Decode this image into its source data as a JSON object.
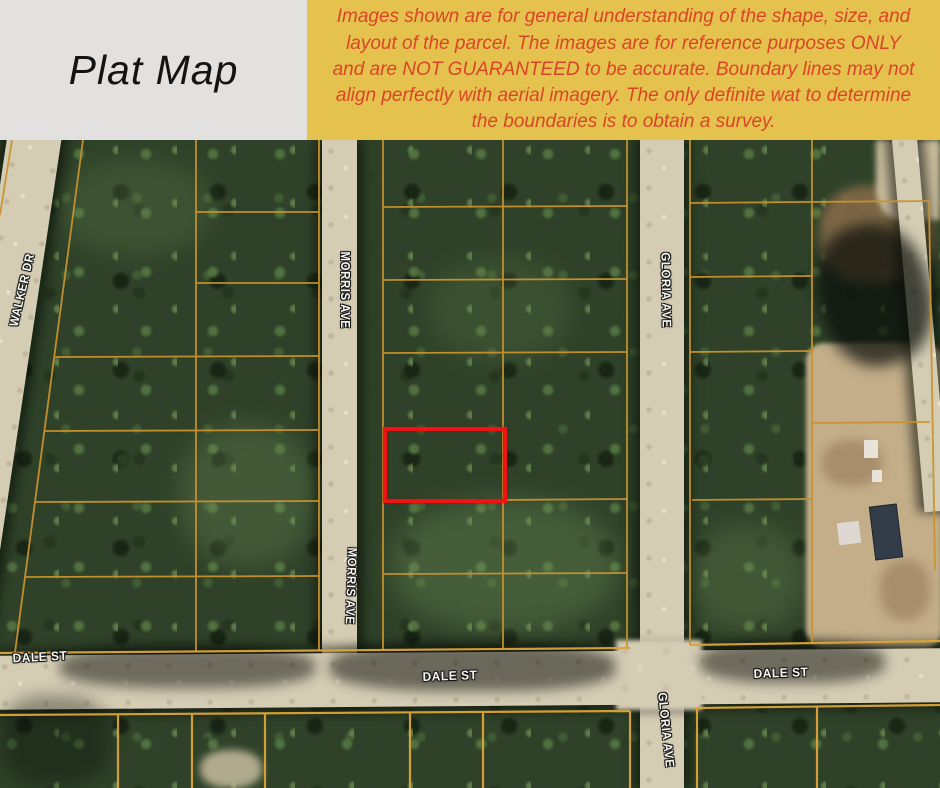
{
  "header": {
    "title": "Plat Map",
    "disclaimer": "Images shown are for general understanding of the shape, size, and layout of the parcel. The images are for reference purposes ONLY and are NOT GUARANTEED to be accurate. Boundary lines may not align perfectly with aerial imagery. The only definite wat to determine the boundaries is to obtain a survey.",
    "colors": {
      "banner_bg": "#e5c14e",
      "banner_text": "#db4527",
      "title_bg": "#e3e1df",
      "title_text": "#141414"
    }
  },
  "map": {
    "type": "aerial-plat-map",
    "street_labels": [
      {
        "id": "walker-dr",
        "name": "WALKER DR"
      },
      {
        "id": "morris-ave-north",
        "name": "MORRIS AVE"
      },
      {
        "id": "morris-ave-south",
        "name": "MORRIS AVE"
      },
      {
        "id": "gloria-ave-north",
        "name": "GLORIA AVE"
      },
      {
        "id": "gloria-ave-south",
        "name": "GLORIA AVE"
      },
      {
        "id": "dale-st-west",
        "name": "DALE ST"
      },
      {
        "id": "dale-st-center",
        "name": "DALE ST"
      },
      {
        "id": "dale-st-east",
        "name": "DALE ST"
      }
    ],
    "highlighted_parcel": {
      "outline_color": "#ec1414",
      "description": "subject parcel outlined in red"
    },
    "parcel_line_color": "#c9932f"
  }
}
